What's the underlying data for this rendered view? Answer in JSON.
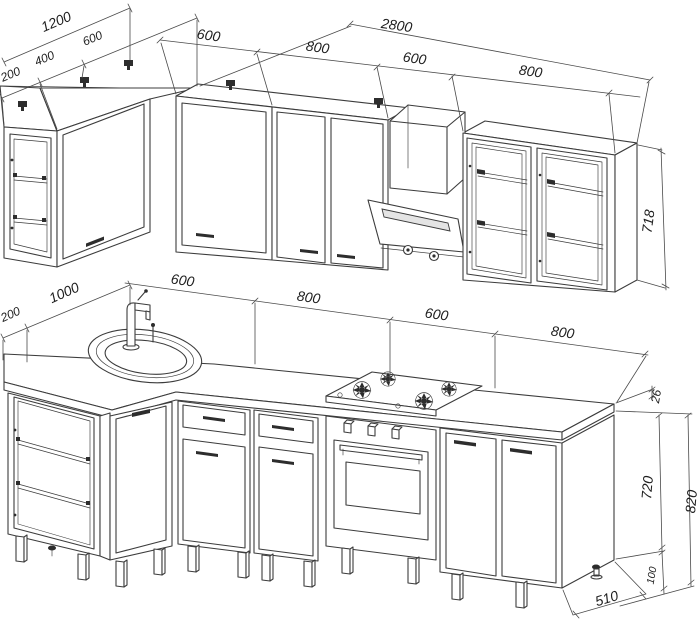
{
  "drawing": {
    "type": "kitchen-corner-set-technical-drawing",
    "palette": {
      "line": "#3c3c3c",
      "dark": "#2d2d2d",
      "background": "#ffffff"
    },
    "dimensions": {
      "upper_left_total": "1200",
      "upper_left_segments": [
        "200",
        "400",
        "600"
      ],
      "upper_run_total": "2800",
      "upper_run_segments": [
        "600",
        "800",
        "600",
        "800"
      ],
      "wall_cabinet_height": "718",
      "counter_left_offset": "200",
      "counter_left_arm": "1000",
      "counter_run_segments": [
        "600",
        "800",
        "600",
        "800"
      ],
      "countertop_thickness": "26",
      "base_cabinet_height": "720",
      "base_total_height": "820",
      "leg_height": "100",
      "base_depth": "510"
    }
  }
}
